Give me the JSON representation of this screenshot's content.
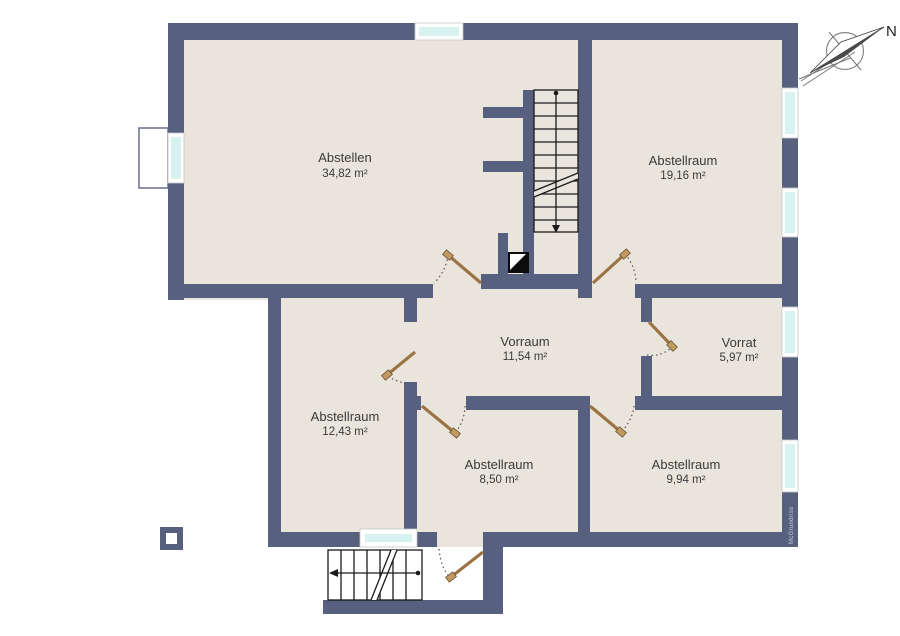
{
  "plan": {
    "title": "basement floor plan",
    "rooms": [
      {
        "name": "Abstellen",
        "area": "34,82 m²"
      },
      {
        "name": "Abstellraum",
        "area": "19,16 m²"
      },
      {
        "name": "Vorraum",
        "area": "11,54 m²"
      },
      {
        "name": "Vorrat",
        "area": "5,97 m²"
      },
      {
        "name": "Abstellraum",
        "area": "12,43 m²"
      },
      {
        "name": "Abstellraum",
        "area": "8,50 m²"
      },
      {
        "name": "Abstellraum",
        "area": "9,94 m²"
      }
    ],
    "compass": {
      "north_label": "N"
    },
    "watermark": "McGrundriss",
    "colors": {
      "wall": "#586080",
      "floor": "#e9e5dc",
      "window_glass": "#d7f2f0",
      "window_frame": "#ffffff",
      "door_leaf": "#9c7345",
      "background": "#ffffff"
    }
  }
}
